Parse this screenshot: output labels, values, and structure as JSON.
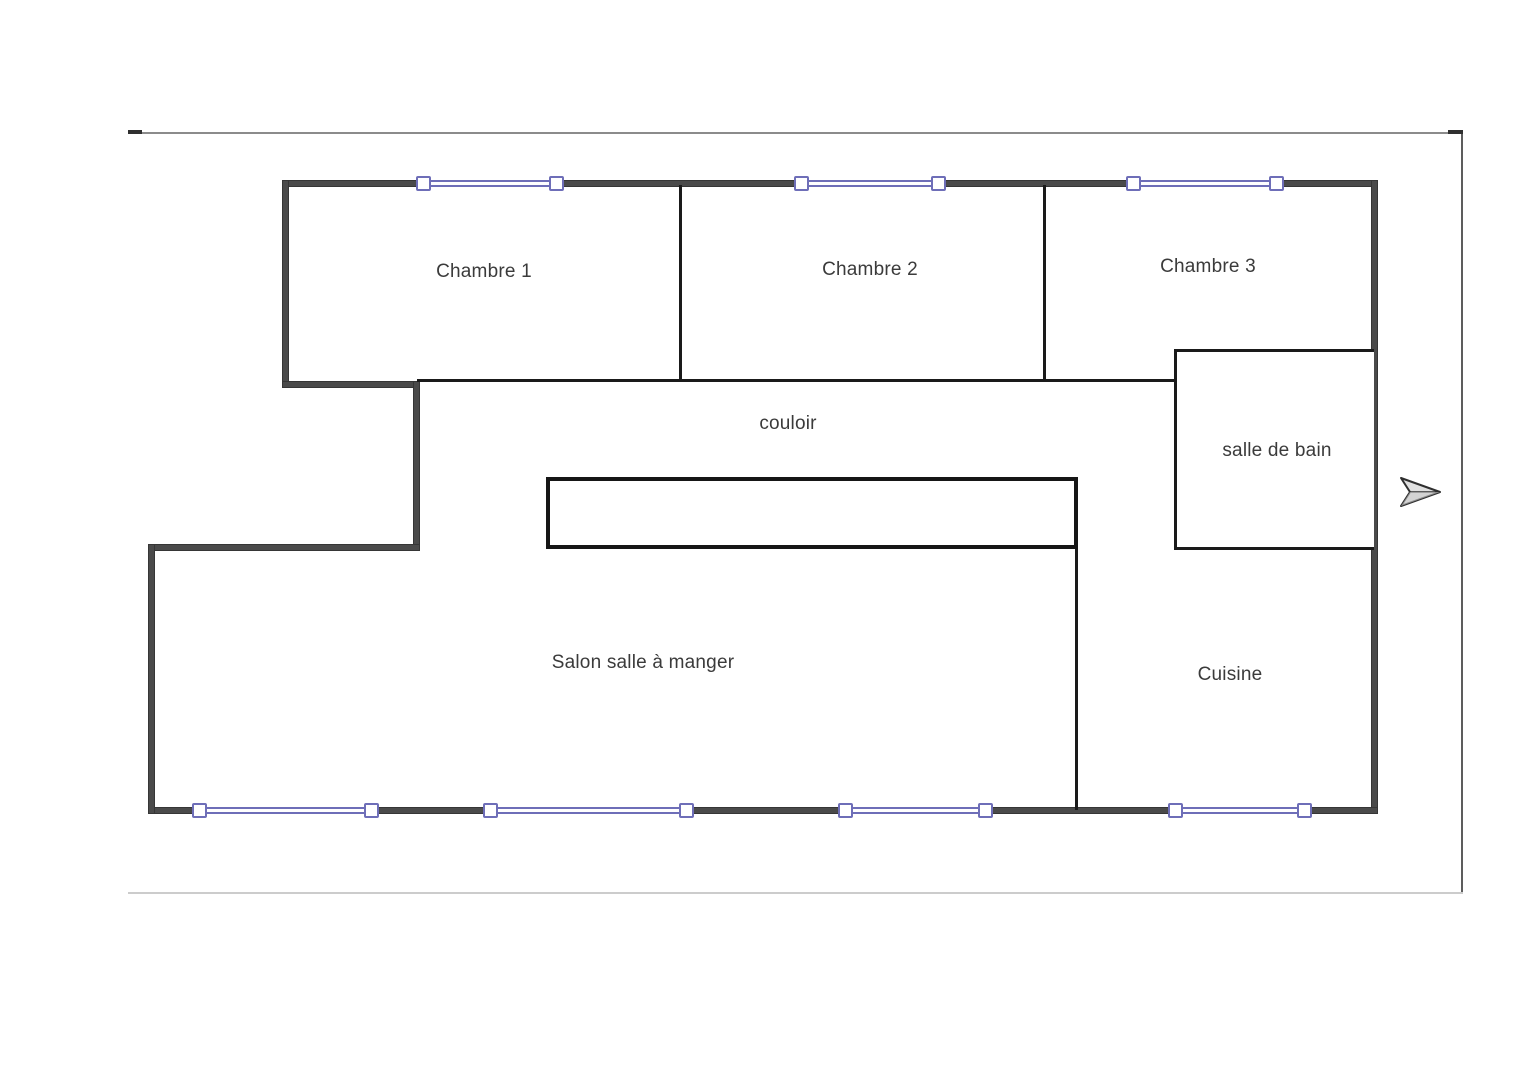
{
  "document": {
    "type": "floor-plan",
    "title": "Plan d'appartement"
  },
  "rooms": {
    "chambre1": {
      "label": "Chambre 1"
    },
    "chambre2": {
      "label": "Chambre 2"
    },
    "chambre3": {
      "label": "Chambre 3"
    },
    "couloir": {
      "label": "couloir"
    },
    "salle_de_bain": {
      "label": "salle de bain"
    },
    "salon": {
      "label": "Salon salle à manger"
    },
    "cuisine": {
      "label": "Cuisine"
    }
  },
  "icons": {
    "arrow": "paper-plane-arrow"
  },
  "colors": {
    "wall": "#4a4a4a",
    "interior_wall": "#1a1a1a",
    "window_accent": "#6e6eb8",
    "label_text": "#3b3b3b"
  },
  "counts": {
    "windows_top": 3,
    "windows_bottom": 4
  }
}
